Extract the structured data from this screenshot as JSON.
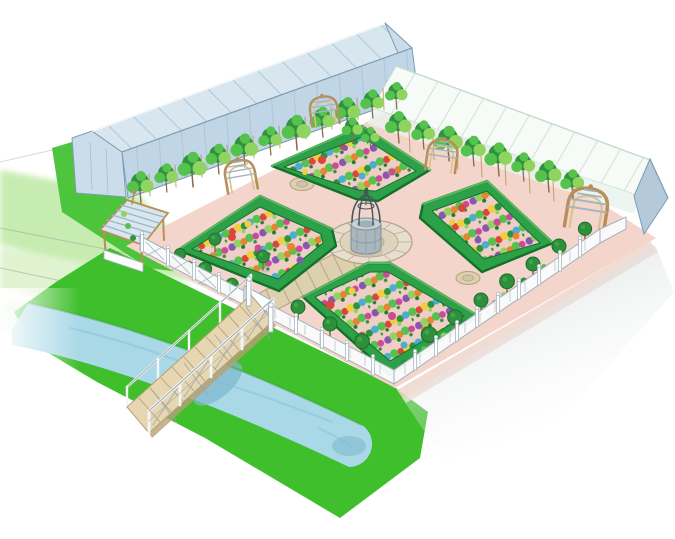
{
  "image": {
    "alt": "Watercolour and pencil aerial illustration of a formal walled kitchen garden: four hedged parterre beds planted in colourful rows around a central stone well, two greenhouses behind, espaliered fruit trees, trellis arches, topiary trees, a white perimeter fence, and a wooden footbridge crossing a blue canal in the foreground",
    "width": 675,
    "height": 539,
    "style": "hand-drawn watercolour with pencil construction lines on white paper"
  },
  "palette": {
    "paper": "#ffffff",
    "pencil": "#9aa0a6",
    "wash_green": "#b9e79e",
    "wash_green_light": "#ddf2cc",
    "lawn": "#46c235",
    "grass": "#3fbf2c",
    "grass_dark": "#2f9e27",
    "stream": "#a9d8e6",
    "stream_deep": "#7db8cc",
    "stream_edge": "#8cc6d8",
    "garden_ground": "#f3d5cc",
    "outer_path": "#eed6cc",
    "stone": "#ddd0ae",
    "stone_line": "#b3a183",
    "plaza": "#e7decf",
    "plaza_mid": "#ded3bd",
    "plaza_core": "#cfc5ad",
    "hedge": "#2da148",
    "hedge_dark": "#15702c",
    "hedge_light": "#6fd276",
    "bed_bg": "#efcfc5",
    "c_g1": "#55c24d",
    "c_g2": "#2f9240",
    "c_g3": "#8fd45e",
    "c_g4": "#1d7f2e",
    "c_red": "#d9473a",
    "c_yel": "#efcf3e",
    "c_org": "#e8842f",
    "c_pur": "#8a54b4",
    "c_blue": "#49aed2",
    "c_mag": "#cc4b98",
    "glass_roof": "#d8e6f0",
    "glass_wall": "#c0d6e6",
    "glass_gable": "#cbdcea",
    "glass_line": "#9db8cc",
    "glass_edge": "#7e9cb4",
    "gh_white": "#f7fbf8",
    "gh_line": "#c3dccf",
    "gh_gable": "#b4c9da",
    "gh_front": "#e9f3ec",
    "wood": "#b98f58",
    "wood_light": "#dcc08d",
    "slat": "#9fb6c2",
    "trunk": "#8a6b4a",
    "topiary": "#2e8f3c",
    "topiary_dark": "#1d6e2c",
    "fence": "#fbfdfe",
    "fence_line": "#9fb0ba",
    "deck": "#e6d7b2",
    "deck_line": "#b7a076",
    "rail": "#f2f6f7",
    "rail_line": "#9aa6ae",
    "wash_grey": "#ccd3d3",
    "well_stone": "#a9b7bd",
    "well_light": "#c6d1d5",
    "well_line": "#7d8e96",
    "iron": "#44565f",
    "shadow_warm": "#b9ab92"
  },
  "scene": {
    "setting": "aerial three-quarter view of a formal walled kitchen garden (potager)",
    "greenhouses": [
      {
        "position": "back left",
        "description": "long greenhouse with pale blue glazed roof and glazing bars"
      },
      {
        "position": "back right",
        "description": "long greenhouse with white panelled roof and blue-grey gable end"
      }
    ],
    "beds": {
      "count": 4,
      "description": "rectangular parterre beds edged with clipped box hedges, inner corners chamfered toward the well, planted in diagonal rows of mixed vegetables and flowers (greens, red, yellow, orange, purple, blue, magenta)"
    },
    "center": "old stone well with wrought-iron dome cage on a circular paved plaza",
    "features": [
      "pink gravel paths radiating between the beds",
      "three small circular stone pavers set in the paths",
      "stone-paved walk from the plaza to the front gate",
      "espaliered fruit trees and vines along both greenhouse fronts",
      "four wooden trellis arches",
      "corner arbour with curved slatted roof",
      "fourteen standard topiary trees with clipped ball heads",
      "low border shrubs and flowers inside the fence line",
      "white perimeter fence with posts",
      "wooden plank footbridge with white railings and cross braces",
      "blue canal crossing the foreground lawn",
      "bright green lawns and soft green washes",
      "faint pencil construction lines at the left edge",
      "soft grey shadow wash at the lower right"
    ],
    "counts": {
      "trellis_arches": 4,
      "topiary_trees": 14,
      "paver_circles": 3,
      "bridge_planks": 10
    }
  }
}
